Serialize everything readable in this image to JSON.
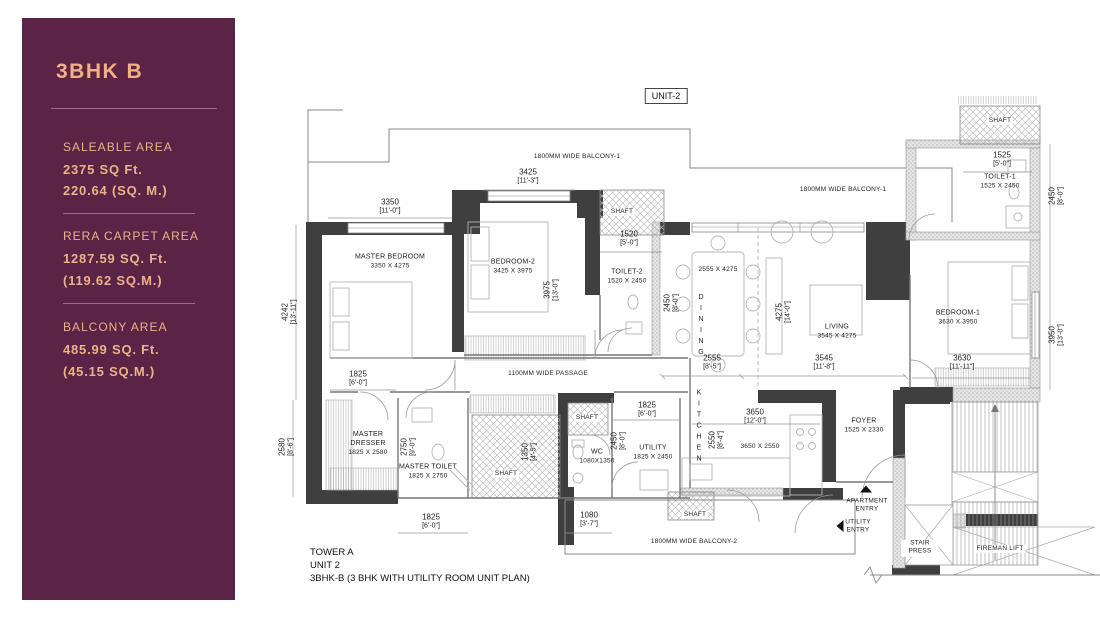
{
  "sidebar": {
    "title": "3BHK B",
    "sections": [
      {
        "label": "SALEABLE AREA",
        "line1": "2375 SQ Ft.",
        "line2": "220.64 (SQ. M.)"
      },
      {
        "label": "RERA CARPET AREA",
        "line1": "1287.59 SQ. Ft.",
        "line2": "(119.62 SQ.M.)"
      },
      {
        "label": "BALCONY AREA",
        "line1": "485.99 SQ. Ft.",
        "line2": "(45.15 SQ.M.)"
      }
    ],
    "bg_color": "#5b2345",
    "text_color": "#ecb28a"
  },
  "plan": {
    "unit_badge": "UNIT-2",
    "shaft_label": "SHAFT",
    "balcony1_label": "1800MM WIDE BALCONY-1",
    "balcony2_label": "1800MM WIDE BALCONY-2",
    "passage_label": "1100MM WIDE PASSAGE",
    "rooms": {
      "master_bedroom": {
        "name": "MASTER BEDROOM",
        "size": "3350 X 4275"
      },
      "bedroom2": {
        "name": "BEDROOM-2",
        "size": "3425 X 3975"
      },
      "toilet2": {
        "name": "TOILET-2",
        "size": "1520 X 2450"
      },
      "dining": {
        "name": "DINING",
        "size": "2555 X 4275"
      },
      "living": {
        "name": "LIVING",
        "size": "3545 X 4275"
      },
      "bedroom1": {
        "name": "BEDROOM-1",
        "size": "3630 X 3950"
      },
      "toilet1": {
        "name": "TOILET-1",
        "size": "1525 X 2450"
      },
      "master_dresser": {
        "name": "MASTER DRESSER",
        "size": "1825 X 2580"
      },
      "master_toilet": {
        "name": "MASTER TOILET",
        "size": "1825 X 2750"
      },
      "wc": {
        "name": "WC",
        "size": "1080X1350"
      },
      "utility": {
        "name": "UTILITY",
        "size": "1825 X 2450"
      },
      "kitchen": {
        "name": "KITCHEN",
        "size": "3650 X 2550"
      },
      "foyer": {
        "name": "FOYER",
        "size": "1525 X 2330"
      },
      "stair_press": {
        "name": "STAIR PRESS"
      },
      "fireman_lift": {
        "name": "FIREMAN LIFT"
      }
    },
    "entries": {
      "apartment": "APARTMENT ENTRY",
      "utility": "UTILITY ENTRY"
    },
    "dims": {
      "mb_width": {
        "mm": "3350",
        "ft": "[11'-0\"]"
      },
      "b2_width": {
        "mm": "3425",
        "ft": "[11'-3\"]"
      },
      "shaft_top_width": {
        "mm": "1520",
        "ft": "[5'-0\"]"
      },
      "t1_width": {
        "mm": "1525",
        "ft": "[5'-0\"]"
      },
      "t1_depth": {
        "mm": "2450",
        "ft": "[8'-0\"]"
      },
      "mb_depth": {
        "mm": "4242",
        "ft": "[13'-11\"]"
      },
      "b2_depth": {
        "mm": "3975",
        "ft": "[13'-0\"]"
      },
      "t2_depth": {
        "mm": "2450",
        "ft": "[8'-0\"]"
      },
      "living_depth": {
        "mm": "4275",
        "ft": "[14'-0\"]"
      },
      "dining_width": {
        "mm": "2555",
        "ft": "[8'-5\"]"
      },
      "living_width": {
        "mm": "3545",
        "ft": "[11'-8\"]"
      },
      "br1_depth": {
        "mm": "3950",
        "ft": "[13'-0\"]"
      },
      "br1_width": {
        "mm": "3630",
        "ft": "[11'-11\"]"
      },
      "dresser_width": {
        "mm": "1825",
        "ft": "[6'-0\"]"
      },
      "dresser_depth": {
        "mm": "2580",
        "ft": "[8'-6\"]"
      },
      "mt_depth": {
        "mm": "2750",
        "ft": "[9'-0\"]"
      },
      "shaft_mid_width": {
        "mm": "1350",
        "ft": "[4'-5\"]"
      },
      "mt_width": {
        "mm": "1825",
        "ft": "[6'-0\"]"
      },
      "wc_width": {
        "mm": "1080",
        "ft": "[3'-7\"]"
      },
      "utility_width": {
        "mm": "1825",
        "ft": "[6'-0\"]"
      },
      "utility_depth": {
        "mm": "2450",
        "ft": "[8'-0\"]"
      },
      "kitchen_depth": {
        "mm": "2550",
        "ft": "[8'-4\"]"
      },
      "kitchen_width": {
        "mm": "3650",
        "ft": "[12'-0\"]"
      }
    },
    "footer": {
      "line1": "TOWER A",
      "line2": "UNIT 2",
      "line3": "3BHK-B (3 BHK WITH UTILITY ROOM UNIT PLAN)"
    }
  }
}
